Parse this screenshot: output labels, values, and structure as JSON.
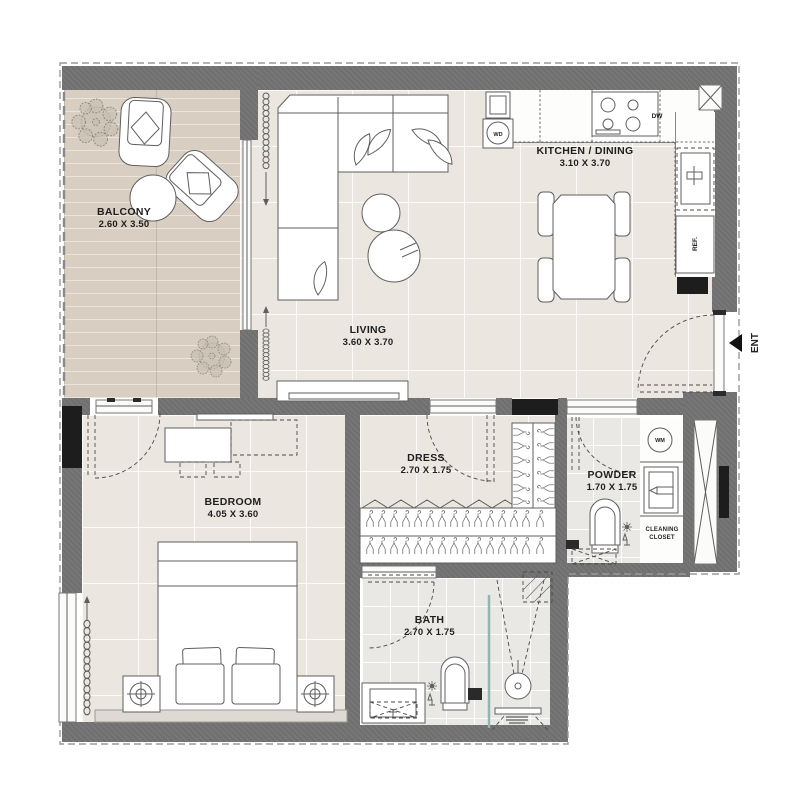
{
  "plan": {
    "rooms": {
      "balcony": {
        "name": "BALCONY",
        "dims": "2.60 X 3.50"
      },
      "living": {
        "name": "LIVING",
        "dims": "3.60 X 3.70"
      },
      "kitchen_dining": {
        "name": "KITCHEN / DINING",
        "dims": "3.10 X 3.70"
      },
      "bedroom": {
        "name": "BEDROOM",
        "dims": "4.05 X 3.60"
      },
      "dress": {
        "name": "DRESS",
        "dims": "2.70 X 1.75"
      },
      "powder": {
        "name": "POWDER",
        "dims": "1.70 X 1.75"
      },
      "bath": {
        "name": "BATH",
        "dims": "2.70 X 1.75"
      },
      "cleaning_closet": {
        "line1": "CLEANING",
        "line2": "CLOSET"
      }
    },
    "labels": {
      "entrance": "ENT",
      "washer_dryer": "WD",
      "dishwasher": "DW",
      "refrigerator": "REF.",
      "washing_machine": "WM"
    },
    "colors": {
      "wall": "#6f6f6f",
      "black_fixture": "#1d1d1d",
      "balcony_floor": "#d8cec1",
      "tile_floor": "#ebe6df",
      "bath_floor": "#e9e8e4",
      "shower_glass": "#8fb6b2",
      "line": "#5f5f5f"
    }
  }
}
